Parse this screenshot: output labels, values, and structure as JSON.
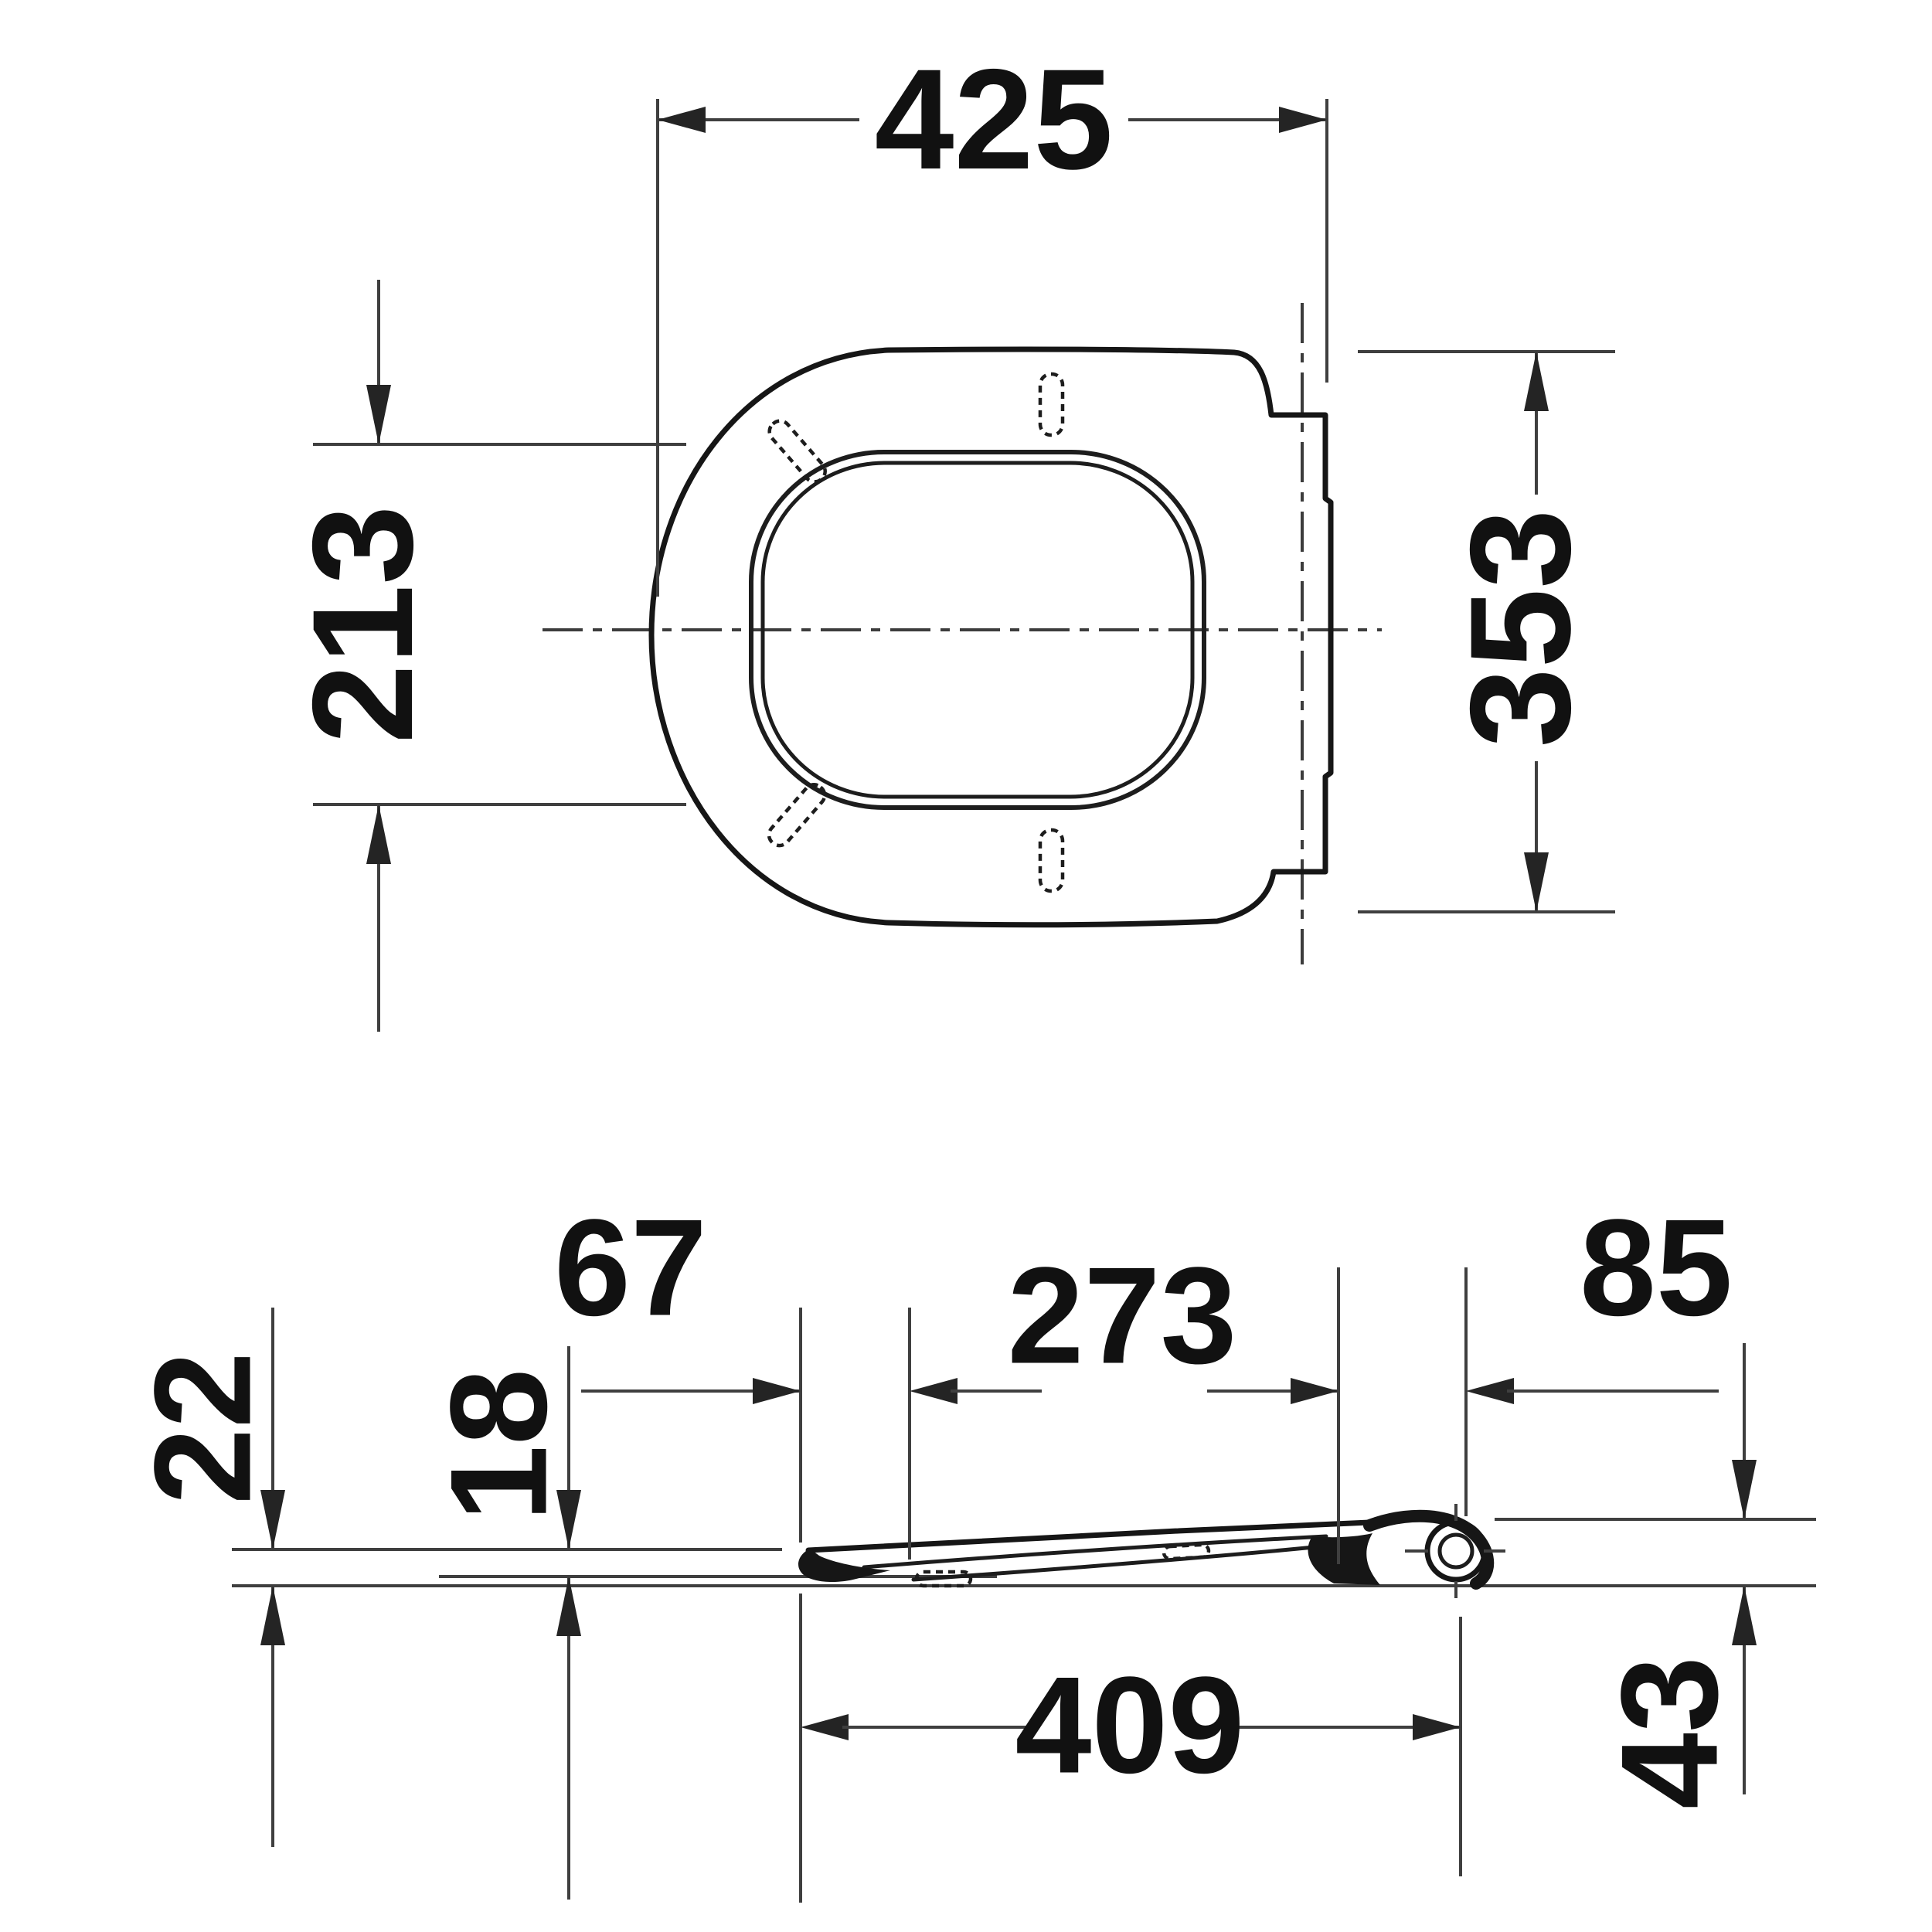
{
  "drawing": {
    "kind": "technical dimension drawing - toilet seat with cover",
    "units": "mm",
    "ink_color": "#161616",
    "dim_line_color": "#3f3f3f",
    "background_color": "#ffffff",
    "top_view": {
      "title": "plan view of seat and lid",
      "width": "425",
      "opening_depth": "213",
      "hinge_edge_width": "353"
    },
    "side_view": {
      "title": "side profile view of seat",
      "lid_front_overhang": "67",
      "ring_front_to_hinge_arm": "273",
      "hinge_overhang": "85",
      "front_height_with_bumper": "22",
      "front_height": "18",
      "front_to_hinge_axis": "409",
      "hinge_height": "43"
    }
  }
}
